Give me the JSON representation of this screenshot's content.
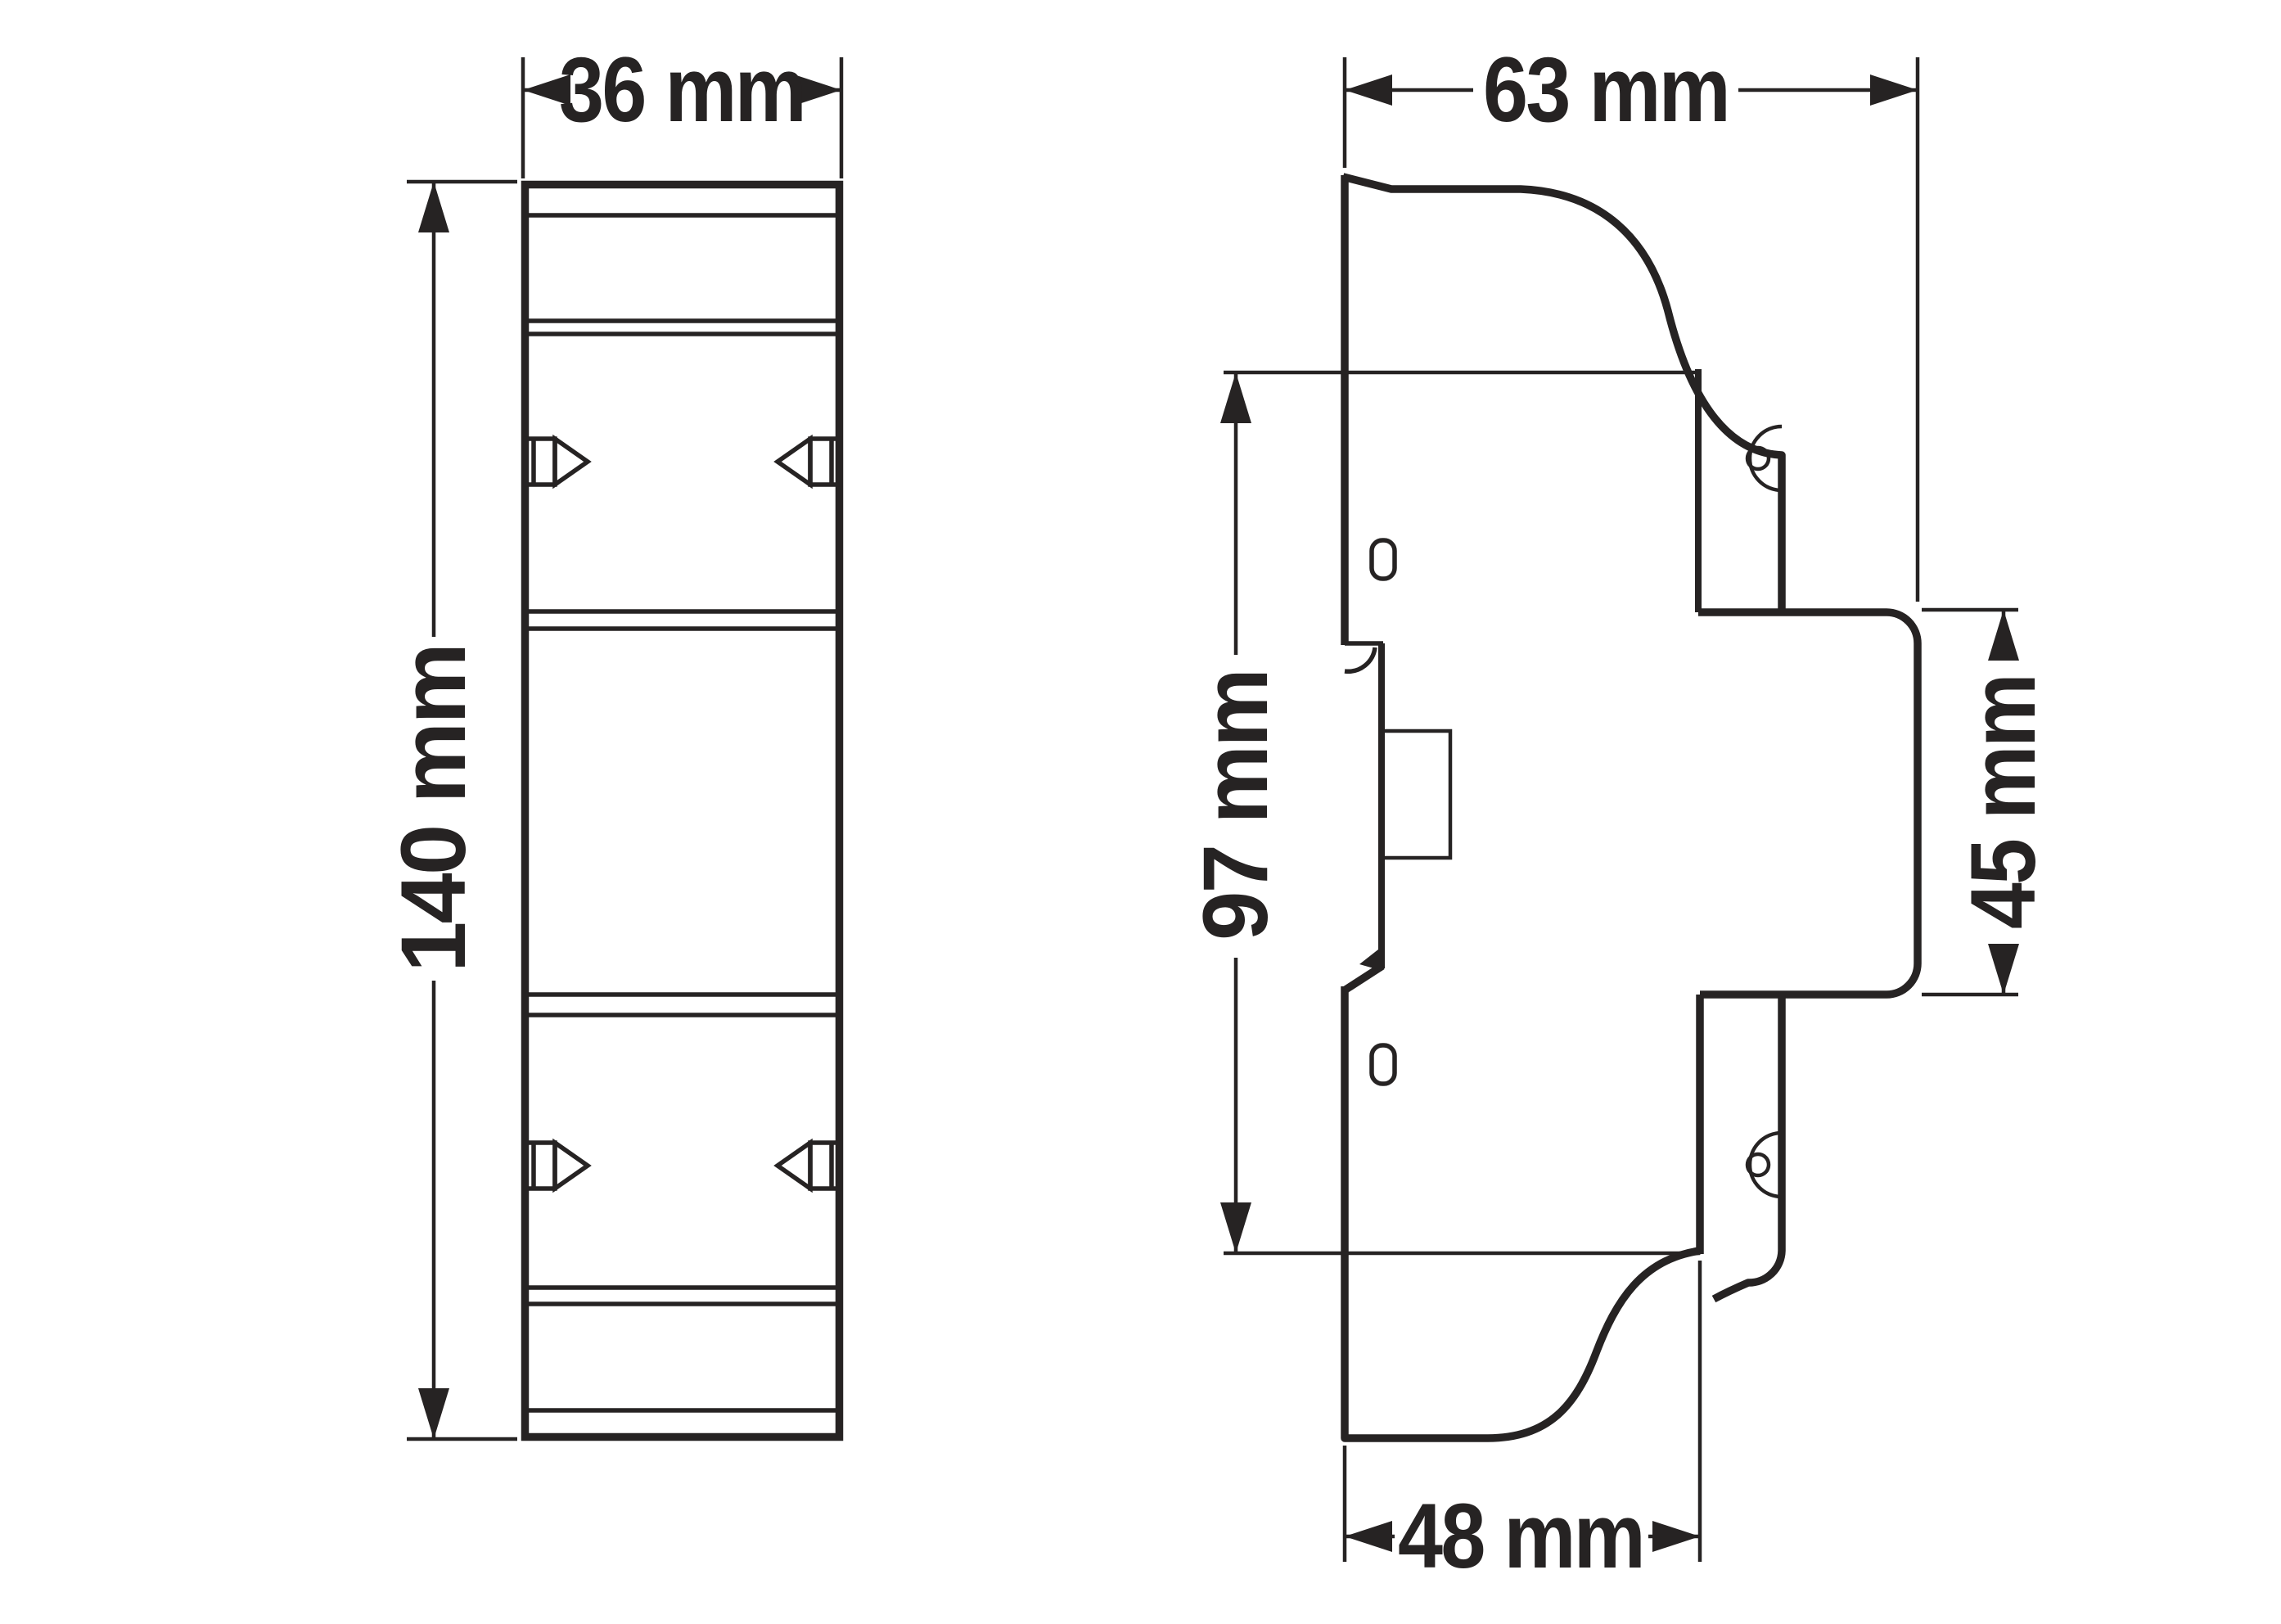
{
  "title": "DIN-rail module dimension drawing",
  "views": {
    "front": {
      "name": "front-view"
    },
    "side": {
      "name": "side-view"
    }
  },
  "dimensions": {
    "front_width": "36 mm",
    "front_height": "140 mm",
    "side_depth": "63 mm",
    "din_section_height": "97 mm",
    "front_panel_height": "45 mm",
    "base_depth": "48 mm"
  },
  "colors": {
    "line": "#262323",
    "background": "#ffffff"
  }
}
